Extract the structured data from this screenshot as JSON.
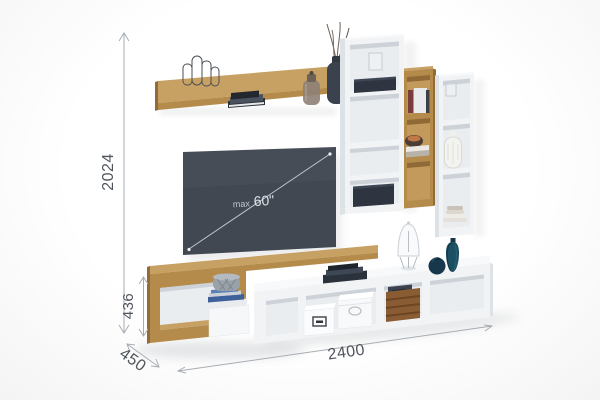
{
  "scene": {
    "description": "3D product render of wall-mounted TV entertainment wall unit in oak and white with dimension callouts",
    "tv_label": {
      "prefix": "max",
      "size": "60\""
    },
    "dimensions": {
      "height": "2024",
      "stand_height": "436",
      "depth": "450",
      "width": "2400"
    },
    "palette": {
      "background": "#fdfdfd",
      "oak_top": "#c7a063",
      "oak_face": "#b58b4c",
      "oak_dark": "#936c35",
      "oak_interior": "#c49a5c",
      "white_face": "#f1f3f5",
      "white_side": "#dde2e6",
      "white_top": "#f7f9fa",
      "white_interior": "#e9edf0",
      "interior_shadow": "#ccd2d8",
      "tv_screen": "#414852",
      "tv_line": "#c2c7cd",
      "dark_decor": "#2e3540",
      "dark_decor_top": "#3d4654",
      "teal_vase": "#1d4f63",
      "navy_vase": "#17384a",
      "crate_wood": "#8a5c33",
      "dim_line": "#a8adb3",
      "dim_text": "#4f555c"
    }
  }
}
